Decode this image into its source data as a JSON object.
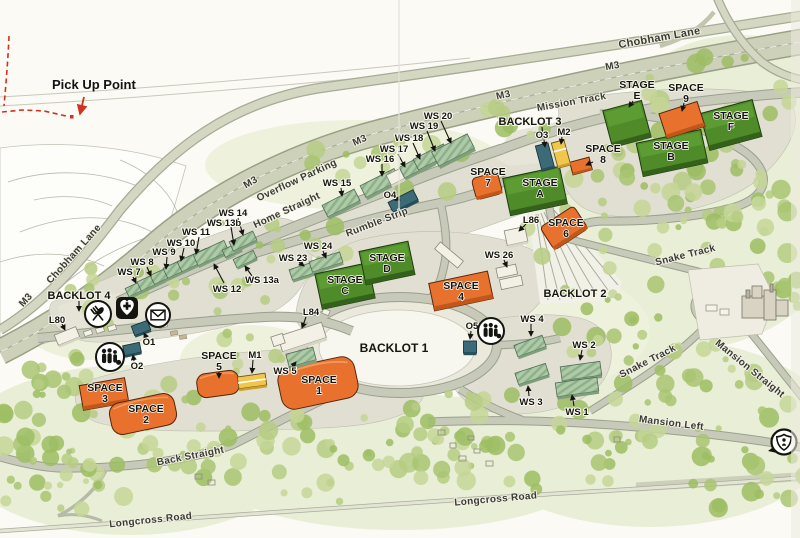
{
  "annotations": {
    "pick_up_point": "Pick Up Point"
  },
  "roads": {
    "chobham_top": "Chobham Lane",
    "chobham_left": "Chobham Lane",
    "m3_a": "M3",
    "m3_b": "M3",
    "m3_c": "M3",
    "m3_d": "M3",
    "m3_e": "M3",
    "overflow": "Overflow Parking",
    "home_straight": "Home Straight",
    "mission_track": "Mission Track",
    "rumble_strip": "Rumble Strip",
    "snake_a": "Snake Track",
    "snake_b": "Snake Track",
    "mansion_straight": "Mansion Straight",
    "mansion_left": "Mansion Left",
    "back_straight": "Back Straight",
    "longcross_a": "Longcross Road",
    "longcross_b": "Longcross Road"
  },
  "stages": {
    "a": [
      "STAGE",
      "A"
    ],
    "b": [
      "STAGE",
      "B"
    ],
    "c": [
      "STAGE",
      "C"
    ],
    "d": [
      "STAGE",
      "D"
    ],
    "e": [
      "STAGE",
      "E"
    ],
    "f": [
      "STAGE",
      "F"
    ]
  },
  "spaces": {
    "s1": [
      "SPACE",
      "1"
    ],
    "s2": [
      "SPACE",
      "2"
    ],
    "s3": [
      "SPACE",
      "3"
    ],
    "s4": [
      "SPACE",
      "4"
    ],
    "s5": [
      "SPACE",
      "5"
    ],
    "s6": [
      "SPACE",
      "6"
    ],
    "s7": [
      "SPACE",
      "7"
    ],
    "s8": [
      "SPACE",
      "8"
    ],
    "s9": [
      "SPACE",
      "9"
    ]
  },
  "workshops": {
    "ws1": "WS 1",
    "ws2": "WS 2",
    "ws3": "WS 3",
    "ws4": "WS 4",
    "ws5": "WS 5",
    "ws7": "WS 7",
    "ws8": "WS 8",
    "ws9": "WS 9",
    "ws10": "WS 10",
    "ws11": "WS 11",
    "ws12": "WS 12",
    "ws13a": "WS 13a",
    "ws13b": "WS 13b",
    "ws14": "WS 14",
    "ws15": "WS 15",
    "ws16": "WS 16",
    "ws17": "WS 17",
    "ws18": "WS 18",
    "ws19": "WS 19",
    "ws20": "WS 20",
    "ws23": "WS 23",
    "ws24": "WS 24",
    "ws26": "WS 26"
  },
  "units": {
    "o1": "O1",
    "o2": "O2",
    "o3": "O3",
    "o4": "O4",
    "o5": "O5",
    "m1": "M1",
    "m2": "M2",
    "l80": "L80",
    "l84": "L84",
    "l86": "L86"
  },
  "backlots": {
    "b1": "BACKLOT 1",
    "b2": "BACKLOT 2",
    "b3": "BACKLOT 3",
    "b4": "BACKLOT 4"
  },
  "icons": {
    "catering": "catering-icon",
    "first_aid": "first-aid-icon",
    "post": "post-icon",
    "toilets_west": "people-icon",
    "toilets_east": "people-icon",
    "security": "security-shield-icon"
  },
  "colors": {
    "stage_green": "#55922e",
    "space_orange": "#e8722d",
    "workshop_green": "#aecaa8",
    "o_teal": "#3c6b77",
    "m_yellow": "#f1c64c",
    "route_red": "#cf3320"
  }
}
